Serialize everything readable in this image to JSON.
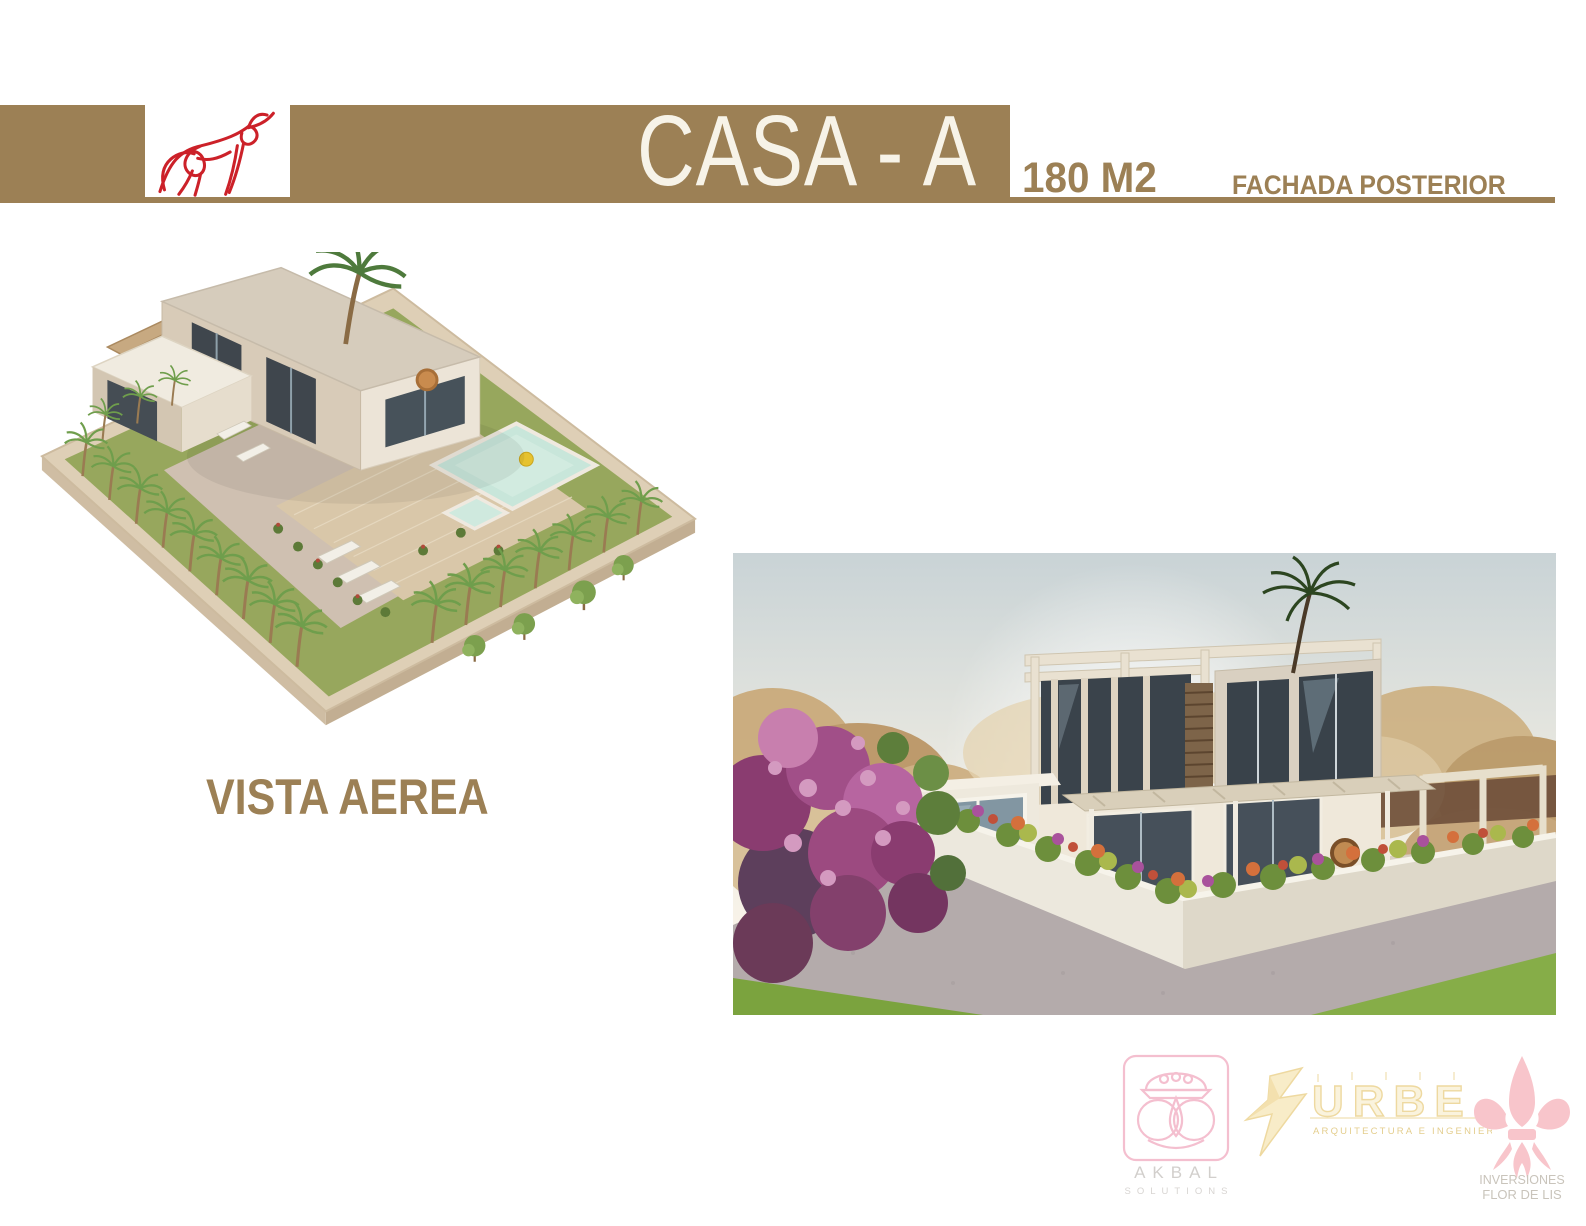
{
  "header": {
    "title": "CASA - A",
    "area": "180 M2",
    "view_label": "FACHADA POSTERIOR"
  },
  "aerial": {
    "caption": "VISTA AEREA"
  },
  "footer": {
    "akbal": {
      "name": "AKBAL",
      "tagline": "SOLUTIONS"
    },
    "urbe": {
      "name": "URBE",
      "tagline": "ARQUITECTURA E INGENIERIA SAS"
    },
    "flor_de_lis": {
      "line1": "INVERSIONES",
      "line2": "FLOR DE LIS"
    }
  },
  "icons": {
    "bull": "bull-logo-icon",
    "akbal": "akbal-logo-icon",
    "urbe": "urbe-logo-icon",
    "fleur": "fleur-de-lis-icon"
  },
  "colors": {
    "brand_brown": "#9c8055",
    "title_white": "#f7f3e8",
    "bull_red": "#cc2129",
    "akbal_pink": "#f4bfcf",
    "urbe_yellow": "#f0d896",
    "fleur_pink": "#f8c5cb",
    "footer_text_gray": "#c9c4bb"
  }
}
